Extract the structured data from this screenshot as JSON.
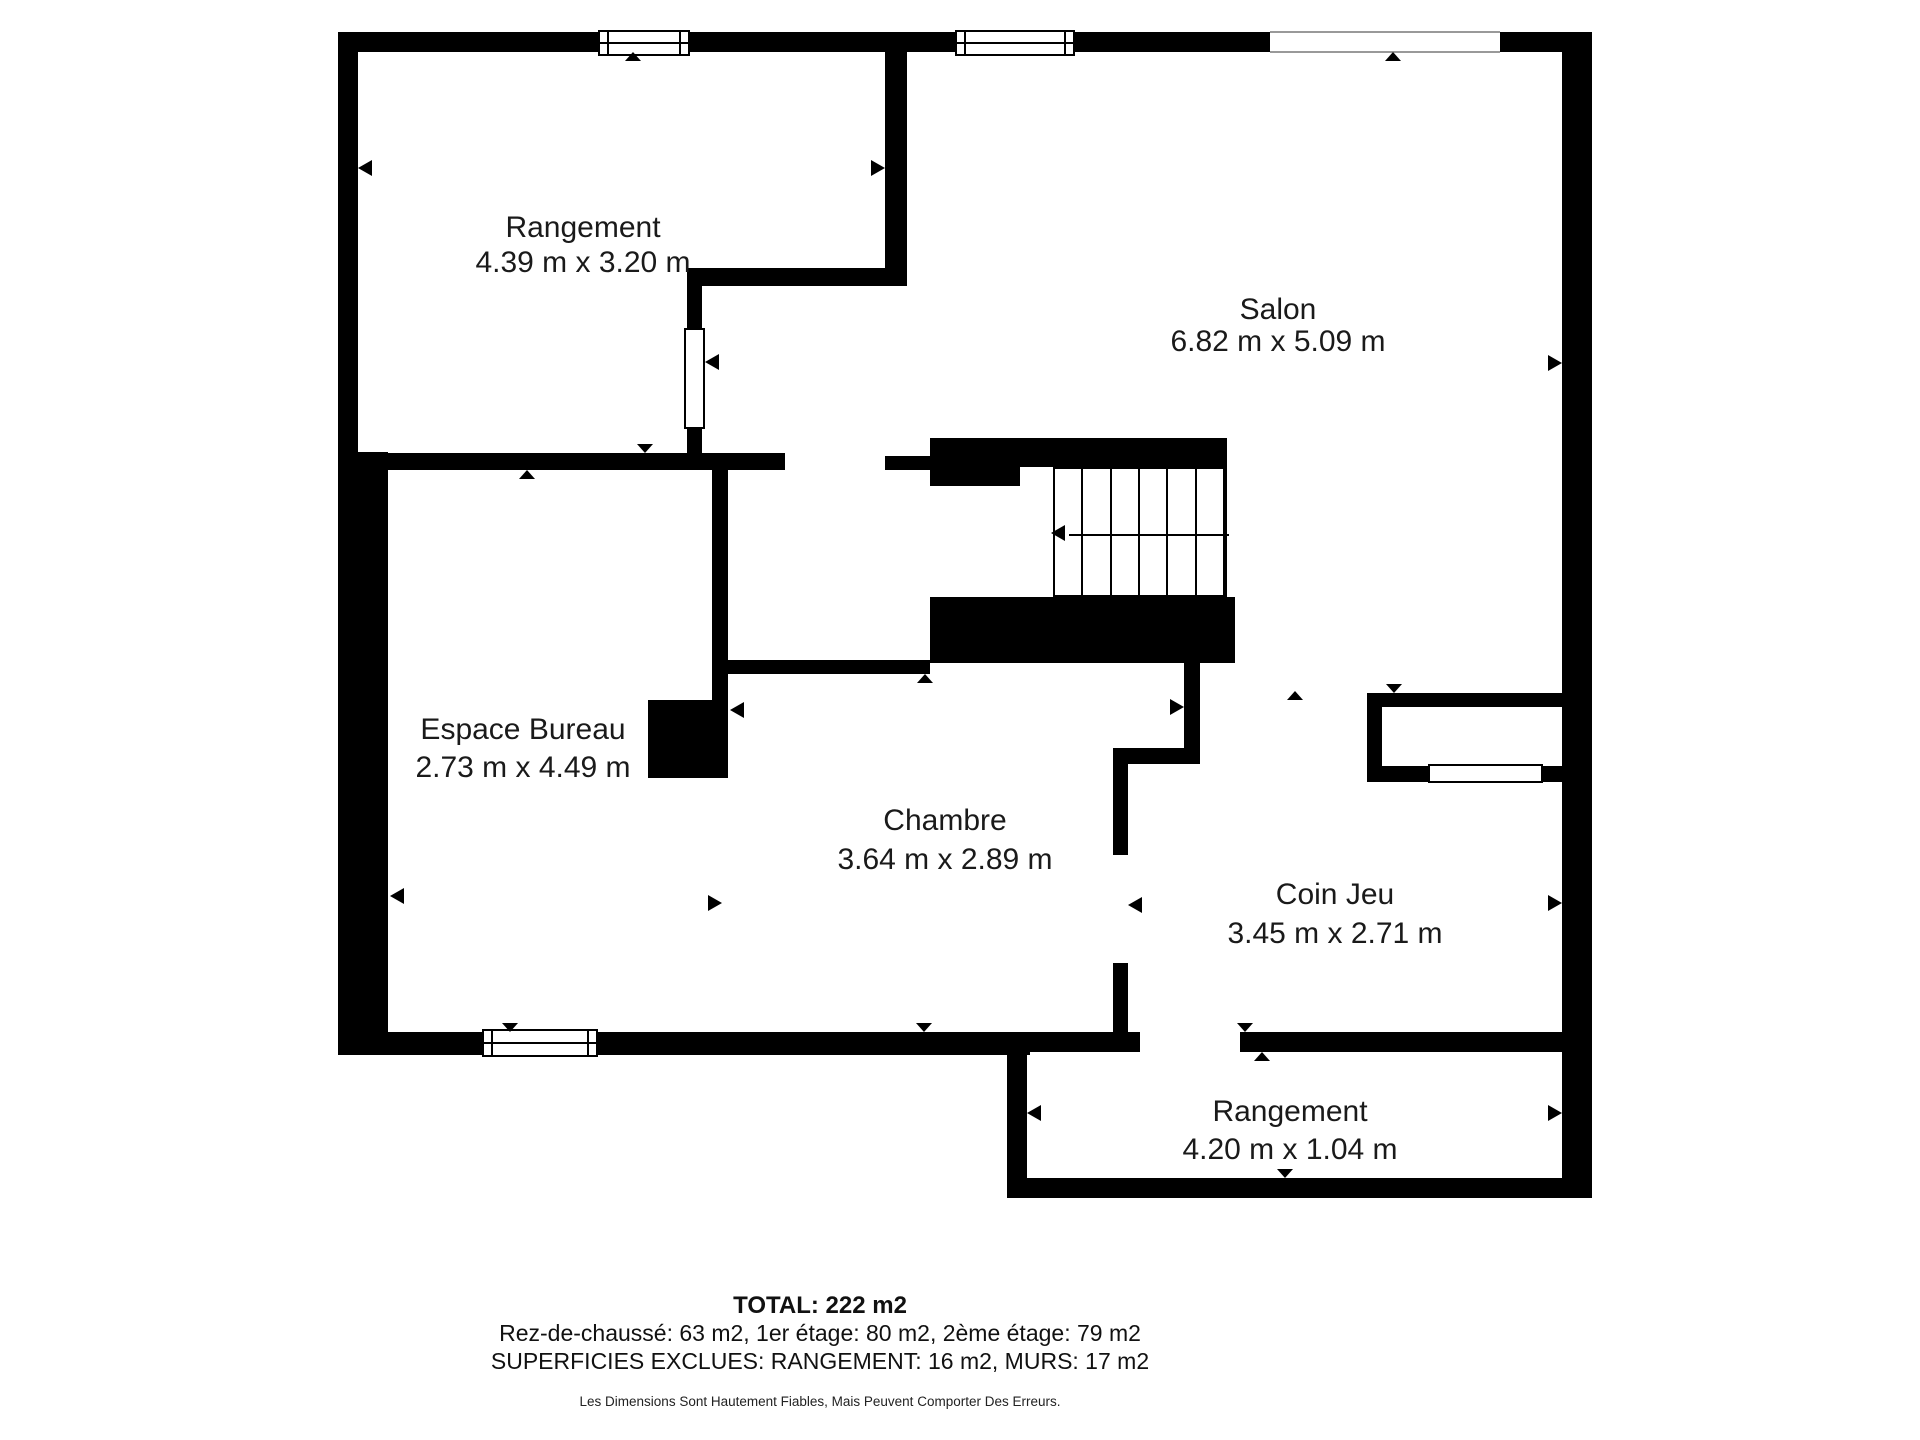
{
  "title": "Floor plan - 1er etage",
  "colors": {
    "wall": "#000000",
    "text": "#1a1a1a",
    "background": "#ffffff"
  },
  "rooms": [
    {
      "name": "Rangement",
      "dims": "4.39 m x 3.20 m",
      "cx": 583,
      "y1": 228,
      "y2": 263
    },
    {
      "name": "Salon",
      "dims": "6.82 m x 5.09 m",
      "cx": 1278,
      "y1": 310,
      "y2": 342
    },
    {
      "name": "Espace Bureau",
      "dims": "2.73 m x 4.49 m",
      "cx": 523,
      "y1": 730,
      "y2": 768
    },
    {
      "name": "Chambre",
      "dims": "3.64 m x 2.89 m",
      "cx": 945,
      "y1": 821,
      "y2": 860
    },
    {
      "name": "Coin Jeu",
      "dims": "3.45 m x 2.71 m",
      "cx": 1335,
      "y1": 895,
      "y2": 934
    },
    {
      "name": "Rangement",
      "dims": "4.20 m x 1.04 m",
      "cx": 1290,
      "y1": 1112,
      "y2": 1150
    }
  ],
  "footer": {
    "total": "TOTAL: 222 m2",
    "floors": "Rez-de-chaussé: 63 m2, 1er étage: 80 m2, 2ème étage: 79 m2",
    "excluded": "SUPERFICIES EXCLUES: RANGEMENT: 16 m2, MURS: 17 m2",
    "disclaimer": "Les Dimensions Sont Hautement Fiables, Mais Peuvent Comporter Des Erreurs.",
    "cx": 820,
    "y_total": 1292,
    "y_floors": 1320,
    "y_excluded": 1348,
    "y_disclaimer": 1394
  },
  "geometry": {
    "walls": [
      [
        338,
        32,
        260,
        20
      ],
      [
        690,
        32,
        265,
        20
      ],
      [
        1075,
        32,
        195,
        20
      ],
      [
        1500,
        32,
        92,
        20
      ],
      [
        338,
        32,
        20,
        438
      ],
      [
        338,
        452,
        50,
        603
      ],
      [
        1562,
        32,
        30,
        1166
      ],
      [
        885,
        32,
        22,
        253
      ],
      [
        687,
        268,
        220,
        18
      ],
      [
        687,
        268,
        15,
        64
      ],
      [
        687,
        425,
        15,
        45
      ],
      [
        338,
        453,
        447,
        17
      ],
      [
        885,
        456,
        45,
        14
      ],
      [
        930,
        438,
        297,
        29
      ],
      [
        930,
        467,
        90,
        19
      ],
      [
        930,
        597,
        305,
        66
      ],
      [
        712,
        458,
        16,
        244
      ],
      [
        648,
        700,
        80,
        78
      ],
      [
        728,
        660,
        202,
        14
      ],
      [
        1184,
        663,
        16,
        87
      ],
      [
        1113,
        748,
        87,
        16
      ],
      [
        1113,
        764,
        15,
        91
      ],
      [
        1113,
        963,
        15,
        73
      ],
      [
        1367,
        693,
        195,
        14
      ],
      [
        1367,
        693,
        15,
        89
      ],
      [
        1382,
        766,
        46,
        16
      ],
      [
        1543,
        766,
        19,
        16
      ],
      [
        338,
        1032,
        144,
        23
      ],
      [
        598,
        1032,
        432,
        23
      ],
      [
        1027,
        1032,
        113,
        20
      ],
      [
        1240,
        1032,
        322,
        20
      ],
      [
        1007,
        1032,
        20,
        166
      ],
      [
        1007,
        1178,
        585,
        20
      ]
    ],
    "windows": [
      {
        "x": 598,
        "y": 30,
        "w": 92,
        "h": 26,
        "kind": "full"
      },
      {
        "x": 955,
        "y": 30,
        "w": 120,
        "h": 26,
        "kind": "full"
      },
      {
        "x": 482,
        "y": 1029,
        "w": 116,
        "h": 28,
        "kind": "full"
      },
      {
        "x": 1428,
        "y": 764,
        "w": 115,
        "h": 19,
        "kind": "plain"
      }
    ],
    "openings": [
      {
        "x": 1270,
        "y": 31,
        "w": 230,
        "h": 22
      }
    ],
    "doors": [
      {
        "x": 684,
        "y": 328,
        "w": 21,
        "h": 101
      }
    ],
    "stairs": {
      "x": 1053,
      "y": 467,
      "w": 174,
      "h": 130,
      "treads": 6,
      "run_y": 533,
      "run_x1": 1067,
      "run_x2": 1227
    },
    "markers": [
      {
        "x": 633,
        "y": 52,
        "d": "up"
      },
      {
        "x": 1393,
        "y": 52,
        "d": "up"
      },
      {
        "x": 358,
        "y": 168,
        "d": "left"
      },
      {
        "x": 885,
        "y": 168,
        "d": "right"
      },
      {
        "x": 705,
        "y": 362,
        "d": "left"
      },
      {
        "x": 1562,
        "y": 363,
        "d": "right"
      },
      {
        "x": 645,
        "y": 453,
        "d": "down"
      },
      {
        "x": 527,
        "y": 470,
        "d": "up"
      },
      {
        "x": 1051,
        "y": 533,
        "d": "left"
      },
      {
        "x": 925,
        "y": 674,
        "d": "up"
      },
      {
        "x": 730,
        "y": 710,
        "d": "left"
      },
      {
        "x": 1394,
        "y": 693,
        "d": "down"
      },
      {
        "x": 1295,
        "y": 691,
        "d": "up"
      },
      {
        "x": 1184,
        "y": 707,
        "d": "right"
      },
      {
        "x": 722,
        "y": 903,
        "d": "right"
      },
      {
        "x": 390,
        "y": 896,
        "d": "left"
      },
      {
        "x": 1128,
        "y": 905,
        "d": "left"
      },
      {
        "x": 1562,
        "y": 903,
        "d": "right"
      },
      {
        "x": 510,
        "y": 1032,
        "d": "down"
      },
      {
        "x": 924,
        "y": 1032,
        "d": "down"
      },
      {
        "x": 1245,
        "y": 1032,
        "d": "down"
      },
      {
        "x": 1262,
        "y": 1052,
        "d": "up"
      },
      {
        "x": 1027,
        "y": 1113,
        "d": "left"
      },
      {
        "x": 1562,
        "y": 1113,
        "d": "right"
      },
      {
        "x": 1285,
        "y": 1178,
        "d": "down"
      }
    ]
  }
}
